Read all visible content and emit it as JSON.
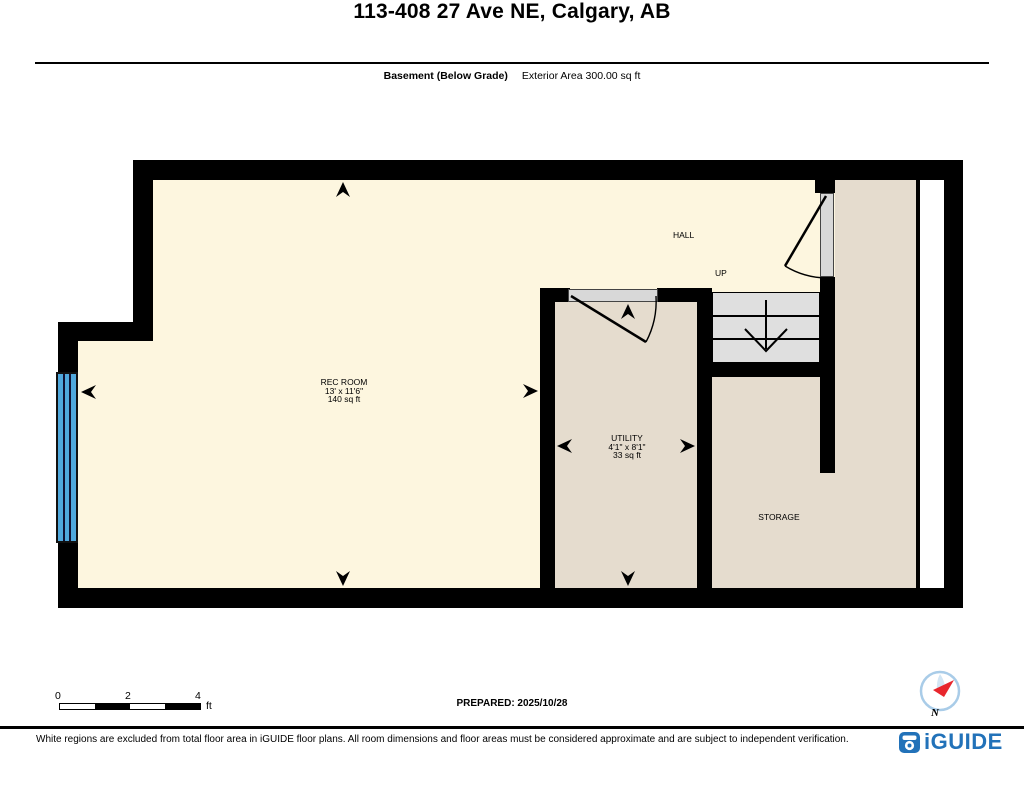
{
  "header": {
    "title": "113-408 27 Ave NE, Calgary, AB",
    "floor_label": "Basement (Below Grade)",
    "area_label": "Exterior Area 300.00 sq ft"
  },
  "rooms": {
    "rec_room": {
      "name": "REC ROOM",
      "dimensions": "13' x 11'6\"",
      "area": "140 sq ft"
    },
    "utility": {
      "name": "UTILITY",
      "dimensions": "4'1\" x 8'1\"",
      "area": "33 sq ft"
    },
    "storage": {
      "name": "STORAGE"
    },
    "hall": {
      "name": "HALL"
    },
    "stairs": {
      "label": "UP"
    }
  },
  "scale_bar": {
    "t0": "0",
    "t2": "2",
    "t4": "4",
    "unit": "ft"
  },
  "footer": {
    "prepared": "PREPARED: 2025/10/28",
    "disclaimer": "White regions are excluded from total floor area in iGUIDE floor plans. All room dimensions and floor areas must be considered approximate and are subject to independent verification.",
    "brand": "iGUIDE",
    "compass_label": "N"
  },
  "colors": {
    "wall": "#000000",
    "room_cream": "#FDF6DF",
    "room_tan": "#E5DCCE",
    "stairs_gray": "#DFDFDF",
    "window_blue": "#4FA8DC",
    "brand_blue": "#2272B9"
  }
}
